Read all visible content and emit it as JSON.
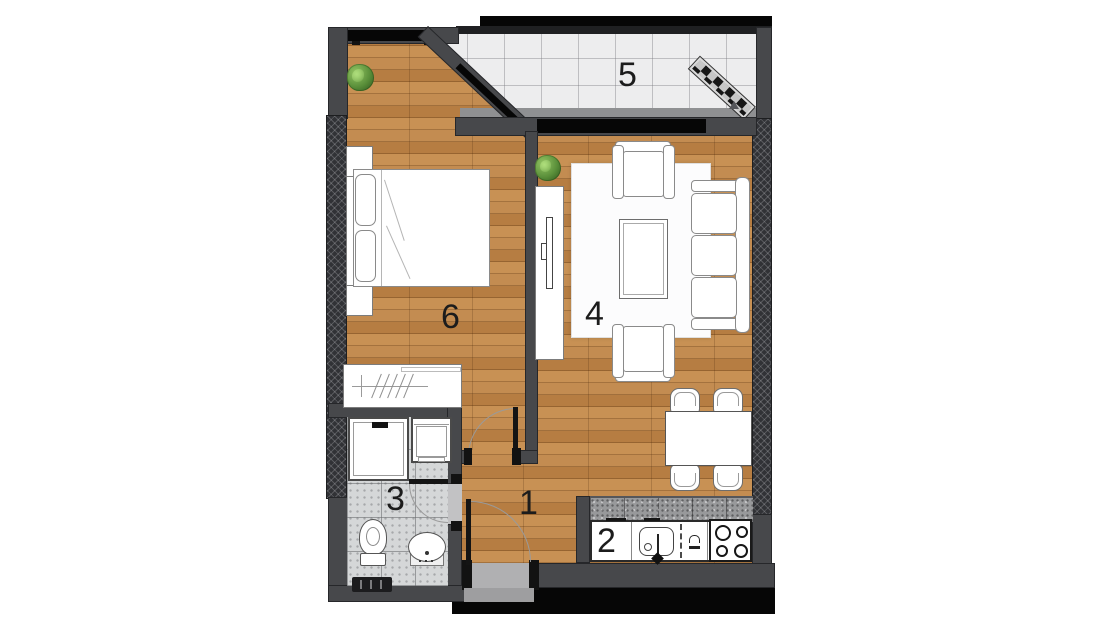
{
  "floorplan": {
    "type": "apartment-top-view-floor-plan",
    "rooms": [
      {
        "number": "1",
        "name": "hallway"
      },
      {
        "number": "2",
        "name": "kitchen"
      },
      {
        "number": "3",
        "name": "bathroom"
      },
      {
        "number": "4",
        "name": "living-dining-room"
      },
      {
        "number": "5",
        "name": "balcony"
      },
      {
        "number": "6",
        "name": "bedroom"
      }
    ],
    "colors": {
      "wall": "#47484b",
      "exterior_hatch_wall": "#313236",
      "wood_floor": "#c08648",
      "balcony_tile": "#ededee",
      "bathroom_tile": "#d5d7d8",
      "kitchen_backsplash": "#98999b",
      "background": "#ffffff",
      "shadow": "#060606",
      "plant_green": "#5a8f3a"
    }
  }
}
